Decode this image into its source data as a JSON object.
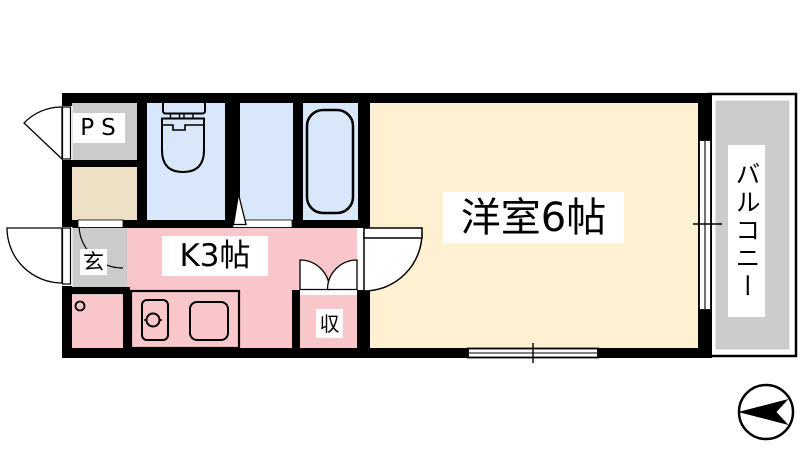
{
  "rooms": {
    "western_room": {
      "label": "洋室6帖",
      "color": "#fdf1d1"
    },
    "kitchen": {
      "label": "K3帖",
      "color": "#f9c6ca"
    },
    "balcony": {
      "label": "バルコニー",
      "color": "#cccccc"
    },
    "pipe_space": {
      "label": "PS",
      "color": "#cbcbcb"
    },
    "entrance": {
      "label": "玄",
      "color": "#cbcbcb"
    },
    "storage": {
      "label": "収",
      "color": "#f9c6ca"
    },
    "wet_area": {
      "color": "#d9e7fa"
    },
    "entry_hall": {
      "color": "#eee0c4"
    }
  },
  "icons": {
    "compass": "north-arrow-pointing-left",
    "toilet": "toilet-fixture",
    "bathtub": "bathtub-fixture",
    "sink": "kitchen-sink-with-faucet",
    "stove": "stove-top",
    "doors": "door-swing-arcs",
    "closet_doors": "double-folding-doors"
  },
  "colors": {
    "wall": "#000000",
    "background": "#ffffff",
    "line": "#000000"
  }
}
